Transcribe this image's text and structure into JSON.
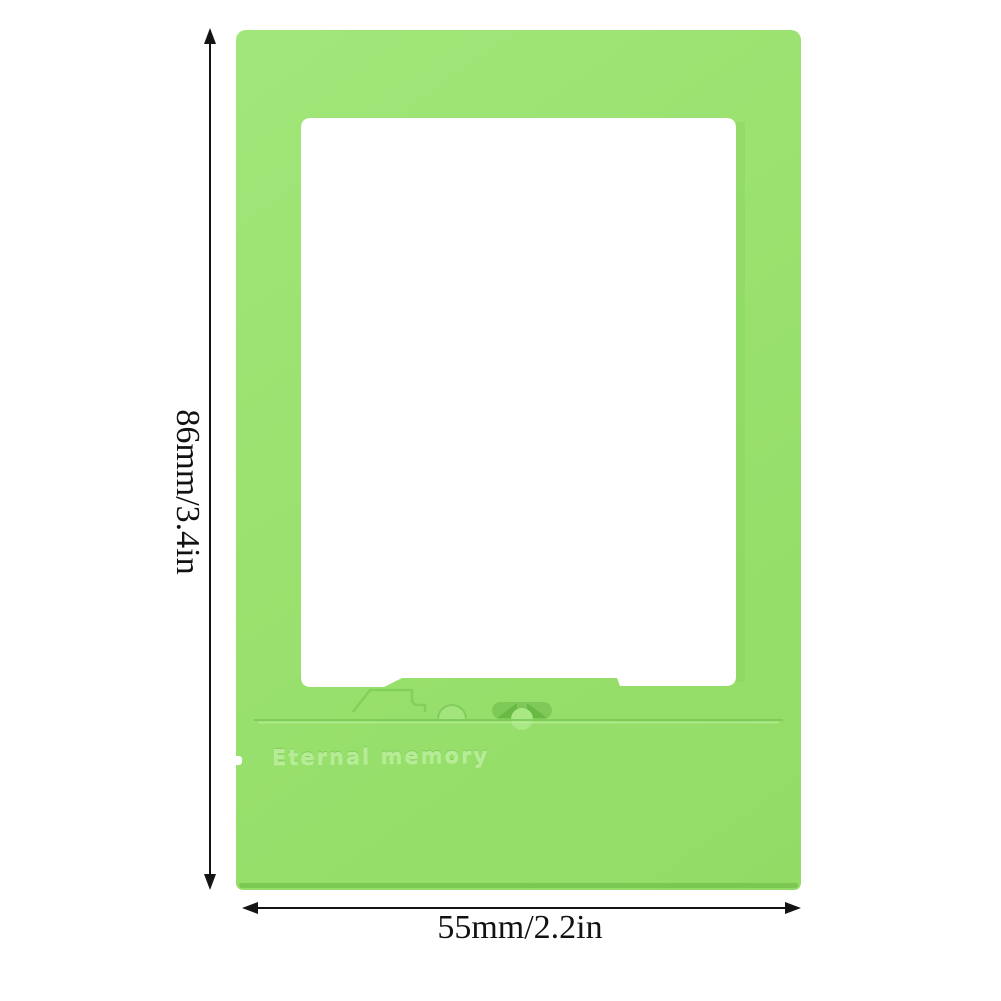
{
  "meta": {
    "image_type": "product-photo",
    "background_hex": "#ffffff"
  },
  "product": {
    "name": "instant-photo-frame",
    "color_hex": "#9ae16f",
    "engraving_text": "Eternal memory"
  },
  "dimensions": {
    "height_label": "86mm/3.4in",
    "width_label": "55mm/2.2in",
    "line_color_hex": "#141414"
  }
}
